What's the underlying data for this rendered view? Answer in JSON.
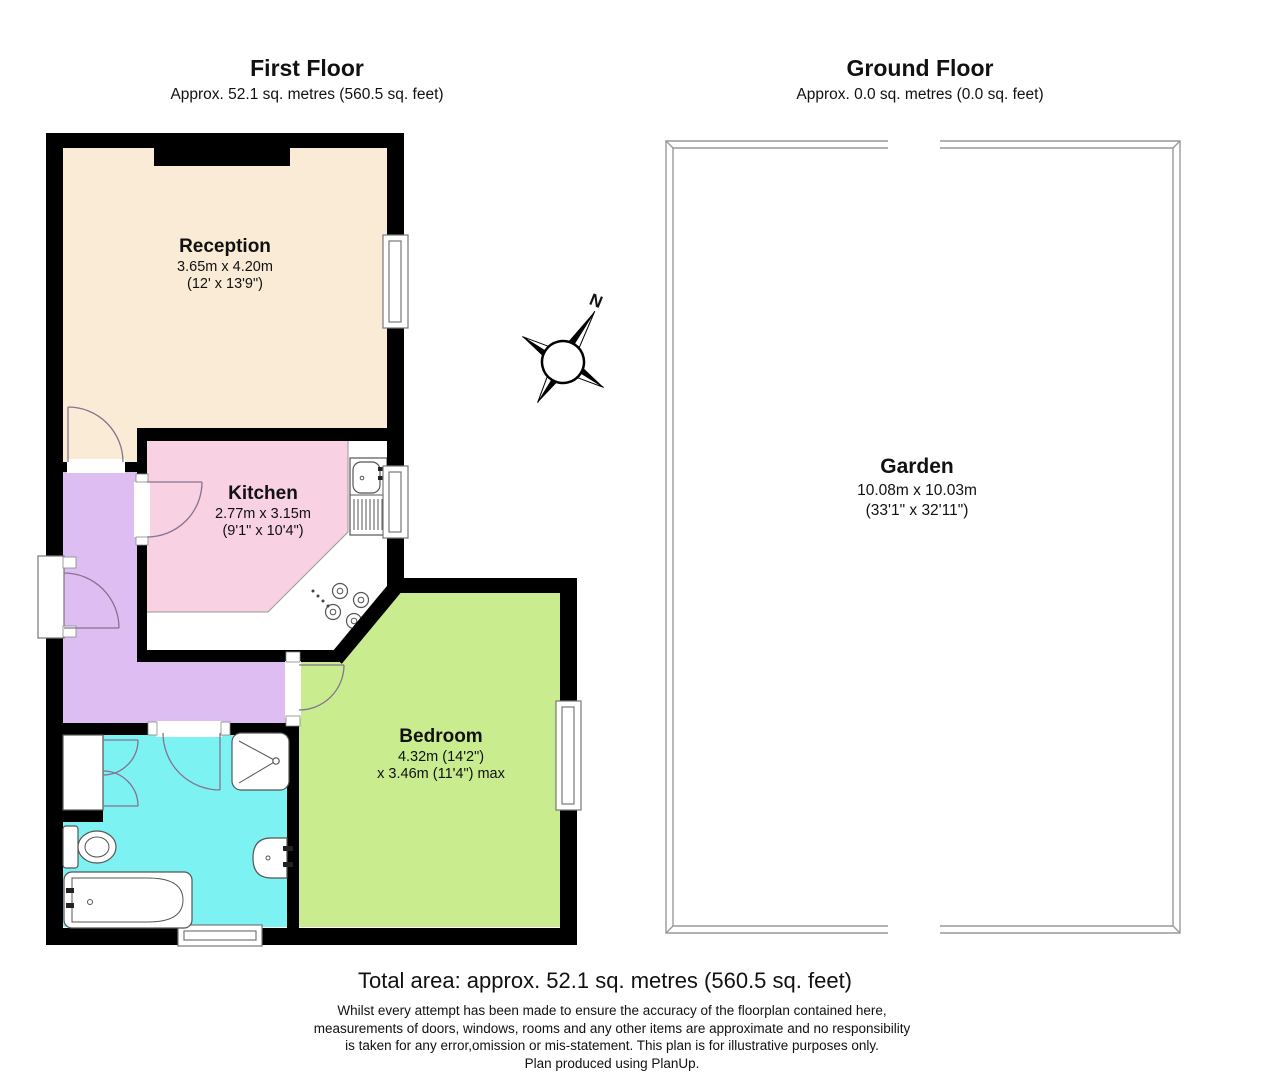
{
  "first_floor": {
    "title": "First Floor",
    "area_label": "Approx. 52.1 sq. metres (560.5 sq. feet)",
    "rooms": {
      "reception": {
        "name": "Reception",
        "size_metric": "3.65m x 4.20m",
        "size_imperial": "(12' x 13'9\")"
      },
      "kitchen": {
        "name": "Kitchen",
        "size_metric": "2.77m x 3.15m",
        "size_imperial": "(9'1\" x 10'4\")"
      },
      "bedroom": {
        "name": "Bedroom",
        "size_line1": "4.32m (14'2\")",
        "size_line2": "x 3.46m (11'4\") max"
      }
    }
  },
  "ground_floor": {
    "title": "Ground Floor",
    "area_label": "Approx. 0.0 sq. metres (0.0 sq. feet)",
    "garden": {
      "name": "Garden",
      "size_metric": "10.08m x 10.03m",
      "size_imperial": "(33'1\" x 32'11\")"
    }
  },
  "compass": {
    "north_label": "N"
  },
  "footer": {
    "total_area": "Total area: approx. 52.1 sq. metres (560.5 sq. feet)",
    "disclaimer_lines": [
      "Whilst every attempt has been made to ensure the accuracy of the floorplan contained here,",
      "measurements of doors, windows, rooms and any other items are approximate and no responsibility",
      "is taken for any error,omission or mis-statement. This plan is for illustrative purposes only.",
      "Plan produced using PlanUp."
    ]
  },
  "colors": {
    "wall": "#000000",
    "reception": "#FAEBD7",
    "kitchen": "#F8D1E3",
    "hallway": "#DEBEF2",
    "bedroom": "#C9EC8E",
    "bathroom": "#7DF2F2",
    "garden_border": "#999999"
  }
}
